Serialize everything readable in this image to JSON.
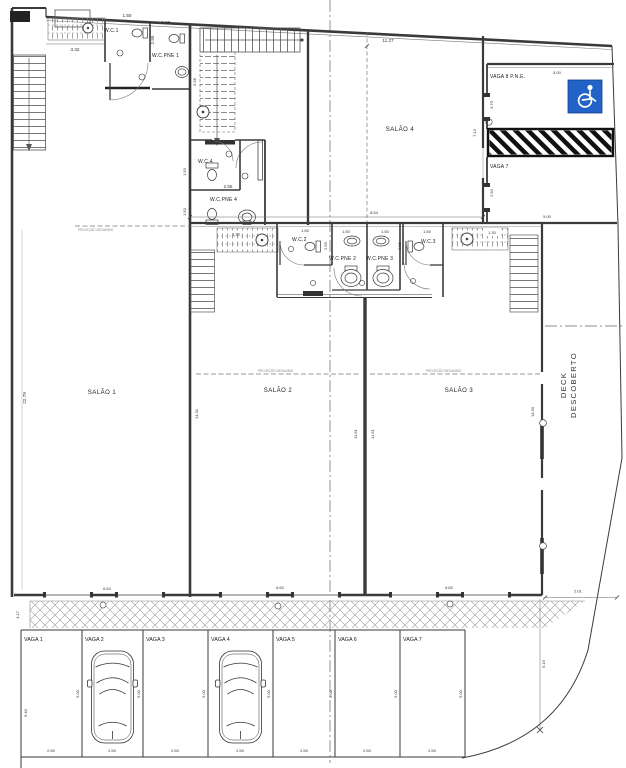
{
  "colors": {
    "accent_blue": "#2263c8",
    "line_dark": "#3a3a3a"
  },
  "rooms": {
    "salao1": "SALÃO 1",
    "salao2": "SALÃO 2",
    "salao3": "SALÃO 3",
    "salao4": "SALÃO 4",
    "wc1": "W.C.1",
    "wcpne1": "W.C.PNE 1",
    "wc2": "W.C.2",
    "wcpne2": "W.C.PNE 2",
    "wcpne3": "W.C.PNE 3",
    "wc3": "W.C.3",
    "wc4": "W.C.4",
    "wcpne4": "W.C.PNE 4"
  },
  "labels": {
    "deck_line1": "DECK",
    "deck_line2": "DESCOBERTO",
    "projecao": "PROJEÇÃO MEZANINO",
    "vaga8": "VAGA 8 P.N.E.",
    "vaga7_upper": "VAGA 7"
  },
  "parking": {
    "spaces": [
      "VAGA 1",
      "VAGA 2",
      "VAGA 3",
      "VAGA 4",
      "VAGA 5",
      "VAGA 6",
      "VAGA 7"
    ]
  },
  "dims": {
    "d130": "1.30",
    "d150": "1.50",
    "d201": "2.01",
    "d250": "2.50",
    "d255": "2.55",
    "d332": "3.32",
    "d370": "3.70",
    "d417": "4.17",
    "d500": "5.00",
    "d519": "5.19",
    "d640": "6.40",
    "d660": "6.60",
    "d664": "6.64",
    "d713": "7.13",
    "d854": "8.54",
    "d958": "9.58",
    "d1127": "11.27",
    "d1161": "11.61",
    "d1430": "14.30",
    "d1431": "14.31",
    "d2279": "22.79"
  }
}
